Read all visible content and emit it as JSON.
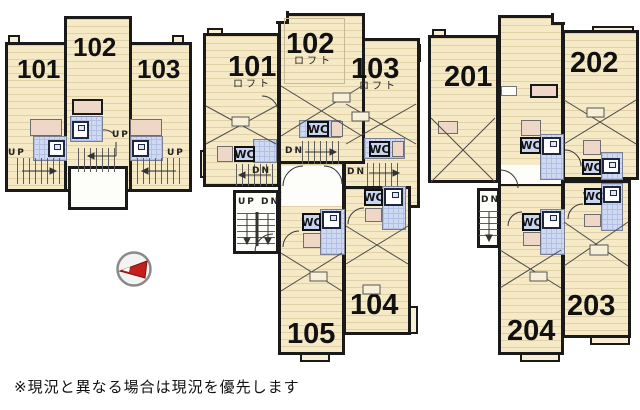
{
  "labels": {
    "wc": "WC",
    "up": "UP",
    "dn": "DN",
    "updn": "UP DN",
    "loft": "ロフト"
  },
  "rooms": {
    "plan1": {
      "r101": "101",
      "r102": "102",
      "r103": "103"
    },
    "plan2": {
      "r101": "101",
      "r102": "102",
      "r103": "103",
      "r104": "104",
      "r105": "105"
    },
    "plan3": {
      "r201": "201",
      "r202": "202",
      "r203": "203",
      "r204": "204"
    }
  },
  "note": "※現況と異なる場合は現況を優先します",
  "colors": {
    "floor": "#f5e9c6",
    "wall": "#1a1a1a",
    "tile": "#cfdaf2",
    "pink": "#eed7c7",
    "north_red": "#c41f1f"
  }
}
